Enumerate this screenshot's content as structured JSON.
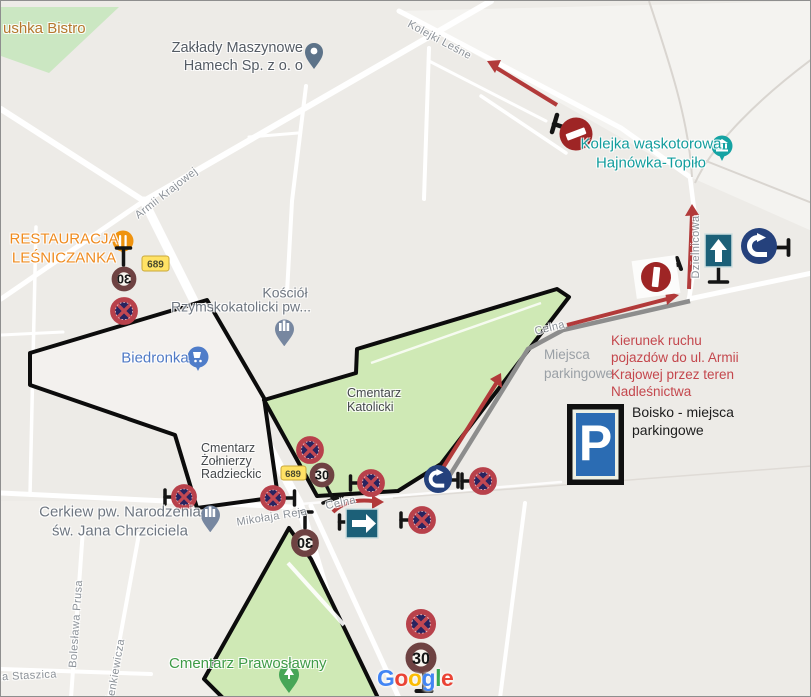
{
  "map_provider": {
    "watermark_letters": [
      "G",
      "o",
      "o",
      "g",
      "l",
      "e"
    ],
    "watermark_colors": [
      "#4285F4",
      "#EA4335",
      "#FBBC05",
      "#4285F4",
      "#34A853",
      "#EA4335"
    ]
  },
  "pois": {
    "bistro": "ushka Bistro",
    "zaklady_line1": "Zakłady Maszynowe",
    "zaklady_line2": "Hamech Sp. z o. o",
    "kolejka_line1": "Kolejka wąskotorowa",
    "kolejka_line2": "Hajnówka-Topiło",
    "restauracja_line1": "RESTAURACJA",
    "restauracja_line2": "LEŚNICZANKA",
    "kosciol_line1": "Kościół",
    "kosciol_line2": "Rzymskokatolicki pw...",
    "biedronka": "Biedronka",
    "cerkiew_line1": "Cerkiew pw. Narodzenia",
    "cerkiew_line2": "św. Jana Chrzciciela",
    "cmentarz_katolicki_line1": "Cmentarz",
    "cmentarz_katolicki_line2": "Katolicki",
    "cmentarz_zolnierzy_line1": "Cmentarz",
    "cmentarz_zolnierzy_line2": "Żołnierzy",
    "cmentarz_zolnierzy_line3": "Radzieckic",
    "cmentarz_prawoslawny": "Cmentarz Prawosławny"
  },
  "streets": {
    "armii_krajowej": "Armii Krajowej",
    "kolejki_lesne": "Kolejki Leśne",
    "dzielnicowa": "Dzielnicowa",
    "celna_upper": "Celna",
    "celna_lower": "Celna",
    "mikolaja_reja": "Mikołaja Reja",
    "boleslawa_prusa": "Bolesława Prusa",
    "sienkiewicza": "ienkiewicza",
    "staszica": "ana Staszica"
  },
  "badges": {
    "road_689": "689"
  },
  "signs": {
    "speed_limit": "30",
    "parking_letter": "P"
  },
  "annotations": {
    "kierunek_lines": [
      "Kierunek ruchu",
      "pojazdów do ul. Armii",
      "Krajowej przez teren",
      "Nadleśnictwa"
    ],
    "boisko_lines": [
      "Boisko - miejsca",
      "parkingowe"
    ],
    "miejsca_lines": [
      "Miejsca",
      "parkingowe"
    ]
  },
  "colors": {
    "arrow_red": "#b23a3a",
    "route_gray": "#8d8d8d",
    "no_stopping_navy": "#282460",
    "sign_ring_red": "#b8414b",
    "speed_ring_maroon": "#6e4242",
    "teal_sign": "#1c6078",
    "roundabout_navy": "#25417c",
    "no_entry_red": "#9e2525",
    "parking_blue": "#2b6cb3",
    "cemetery_green": "#cfe9b5",
    "annotation_red_text": "#c4474d"
  }
}
